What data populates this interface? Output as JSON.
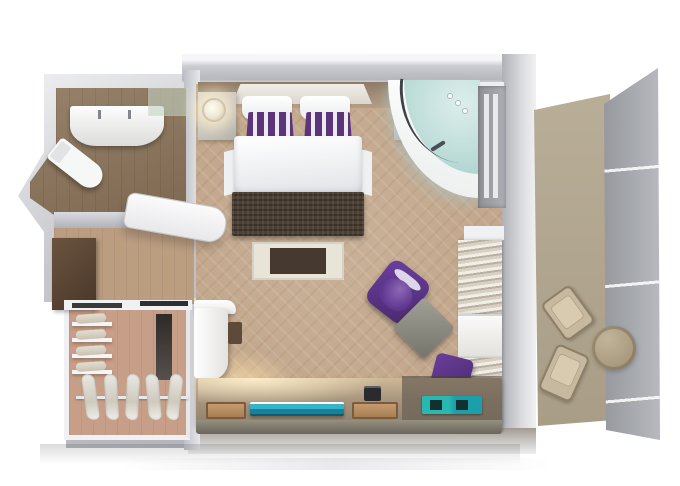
{
  "meta": {
    "description": "3D isometric floor plan render of a hotel suite: bedroom-living area, bathroom, entry hall, walk-in closet and private balcony",
    "visible_text": []
  },
  "colors": {
    "canvas_bg": "#ffffff",
    "wall_fill": "#c6c7cc",
    "floor_main": "#c3a88d",
    "floor_bath": "#8b7359",
    "floor_closet": "#c79f88",
    "floor_hall": "#bb9d80",
    "floor_balcony": "#a89d86",
    "rail_gray": "#a2a5ab",
    "headboard_tan": "#b59e85",
    "pillow_purple": "#5a3579",
    "bench_brown": "#4c4034",
    "rug_light": "#e9e4d8",
    "rug_dark": "#463a30",
    "tub_rim": "#e9edec",
    "tub_water": "#bcdcd8",
    "armchair_purple": "#4a2a6e",
    "chair_purple": "#472771",
    "table_gray": "#75746b",
    "console_wood": "#a99780",
    "tray_wood": "#a87f54",
    "tv_teal": "#35b4c9",
    "magazine_teal": "#28b8b0",
    "minibar_brown": "#4a3728",
    "patio_tan": "#a8997e",
    "glass_green": "#c2d2c0"
  },
  "scene": {
    "rooms": [
      {
        "name": "bathroom",
        "items": [
          "double-sink-vanity",
          "faucets",
          "toilet",
          "shower-glass"
        ]
      },
      {
        "name": "entry-hall",
        "items": [
          "entry-door",
          "minibar-cabinet"
        ]
      },
      {
        "name": "walk-in-closet",
        "items": [
          "shelves-with-folded-clothes",
          "hanging-rail",
          "clothes-hangers",
          "mirror-panel"
        ]
      },
      {
        "name": "bedroom-living",
        "items": [
          "double-bed",
          "white-pillows",
          "purple-striped-pillows",
          "nightstands",
          "wall-sconces",
          "foot-bench",
          "rug",
          "corner-whirlpool-tub",
          "balcony-door",
          "linen-shelves",
          "purple-armchair",
          "gray-side-table",
          "purple-desk-chair",
          "chaise-seat",
          "media-console",
          "tv-panel",
          "wood-trays",
          "telephone",
          "teal-magazines"
        ]
      },
      {
        "name": "balcony",
        "items": [
          "patio-chairs",
          "round-patio-table",
          "glass-railing"
        ]
      }
    ]
  }
}
